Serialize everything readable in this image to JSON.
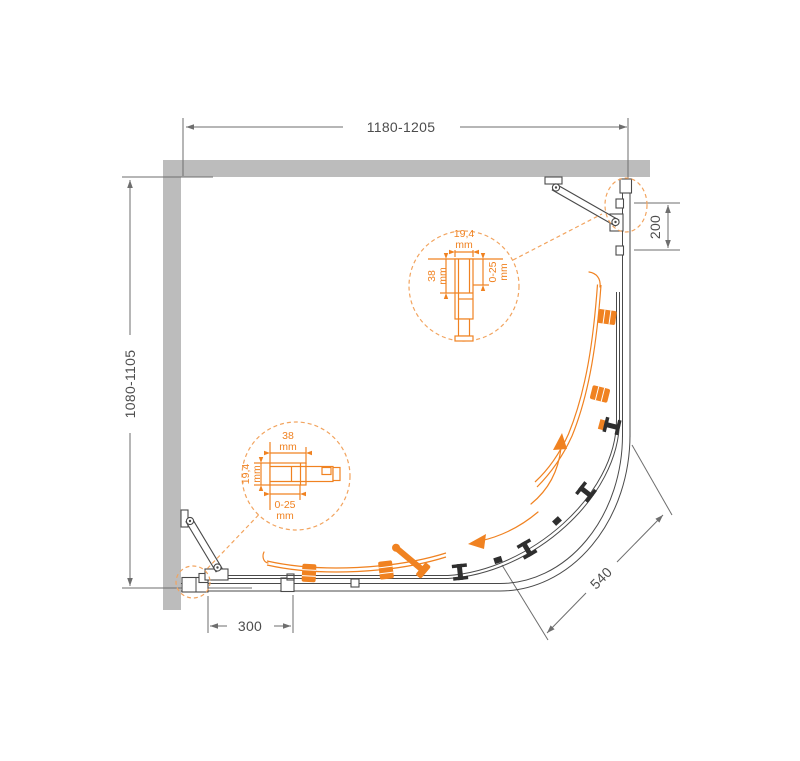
{
  "drawing": {
    "type": "technical-drawing",
    "subject": "quarter-round corner shower enclosure, plan view"
  },
  "dimensions": {
    "top_width": "1180-1205",
    "left_depth": "1080-1105",
    "right_panel_segment": "200",
    "bottom_panel_segment": "300",
    "diagonal_opening": "540"
  },
  "detail_top": {
    "profile_width": "19,4",
    "profile_depth": "38",
    "adjustment_range": "0-25",
    "unit": "mm"
  },
  "detail_bottom": {
    "profile_width": "38",
    "profile_depth": "19,4",
    "adjustment_range": "0-25",
    "unit": "mm"
  },
  "colors": {
    "wall": "#bcbcbc",
    "line": "#4a4a4a",
    "dim": "#6e6e6e",
    "dim_text": "#4d4d4d",
    "accent": "#f08221",
    "accent_light": "#f2a45f",
    "roller": "#2e2e2e"
  }
}
